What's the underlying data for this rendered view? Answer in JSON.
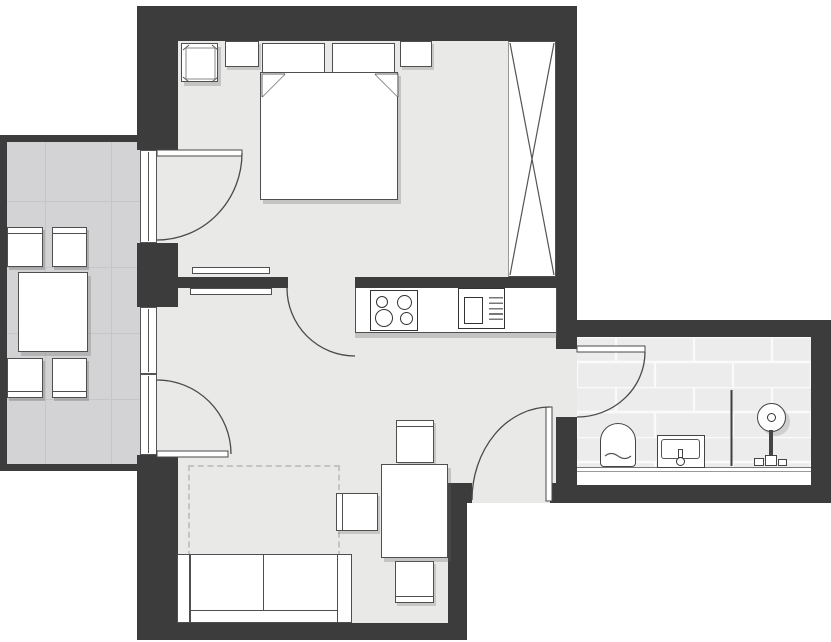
{
  "app": {
    "type": "floor-plan",
    "description": "Top-down architectural floor plan of a one-bedroom apartment with balcony and bathroom wing",
    "visible_text": "none"
  },
  "colors": {
    "wall": "#3c3c3c",
    "floor": "#e9e9e7",
    "balcony_floor": "#d3d3d5",
    "balcony_grid": "#c6c6c9",
    "bath_tile": "#ececec",
    "tile_grout": "#fafafa",
    "furniture": "#ffffff",
    "outline": "#4f4f4f",
    "outline_strong": "#333333",
    "dashed": "#c4c4c4",
    "outside": "#ffffff"
  },
  "rooms": [
    {
      "id": "bedroom",
      "label": "bedroom",
      "furniture": [
        "side stool",
        "left nightstand",
        "double bed with two pillows and folded corners",
        "right nightstand",
        "wardrobe with X symbol"
      ]
    },
    {
      "id": "living-kitchen",
      "label": "living room with open kitchen",
      "furniture": [
        "kitchen counter",
        "four-burner cooktop",
        "kitchen sink with drainer",
        "two wall shelves",
        "dashed rug outline",
        "dining table with three chairs",
        "two-seat sofa"
      ]
    },
    {
      "id": "bathroom",
      "label": "bathroom",
      "furniture": [
        "toilet",
        "washbasin with faucet",
        "shower with glass partition",
        "ledge"
      ]
    },
    {
      "id": "balcony",
      "label": "balcony",
      "furniture": [
        "square table",
        "four chairs"
      ]
    }
  ],
  "doors": [
    {
      "id": "balcony-door-bedroom",
      "connects": "balcony to bedroom",
      "swing": "into bedroom"
    },
    {
      "id": "balcony-door-living",
      "connects": "balcony to living room",
      "swing": "into living room"
    },
    {
      "id": "bedroom-door",
      "connects": "bedroom to living room",
      "swing": "into living room"
    },
    {
      "id": "bathroom-door",
      "connects": "living room to bathroom",
      "swing": "into bathroom"
    },
    {
      "id": "entrance-door",
      "connects": "outside to living room",
      "swing": "into living room"
    }
  ],
  "windows": [
    {
      "id": "living-window",
      "location": "left wall between the two balcony doors"
    }
  ]
}
